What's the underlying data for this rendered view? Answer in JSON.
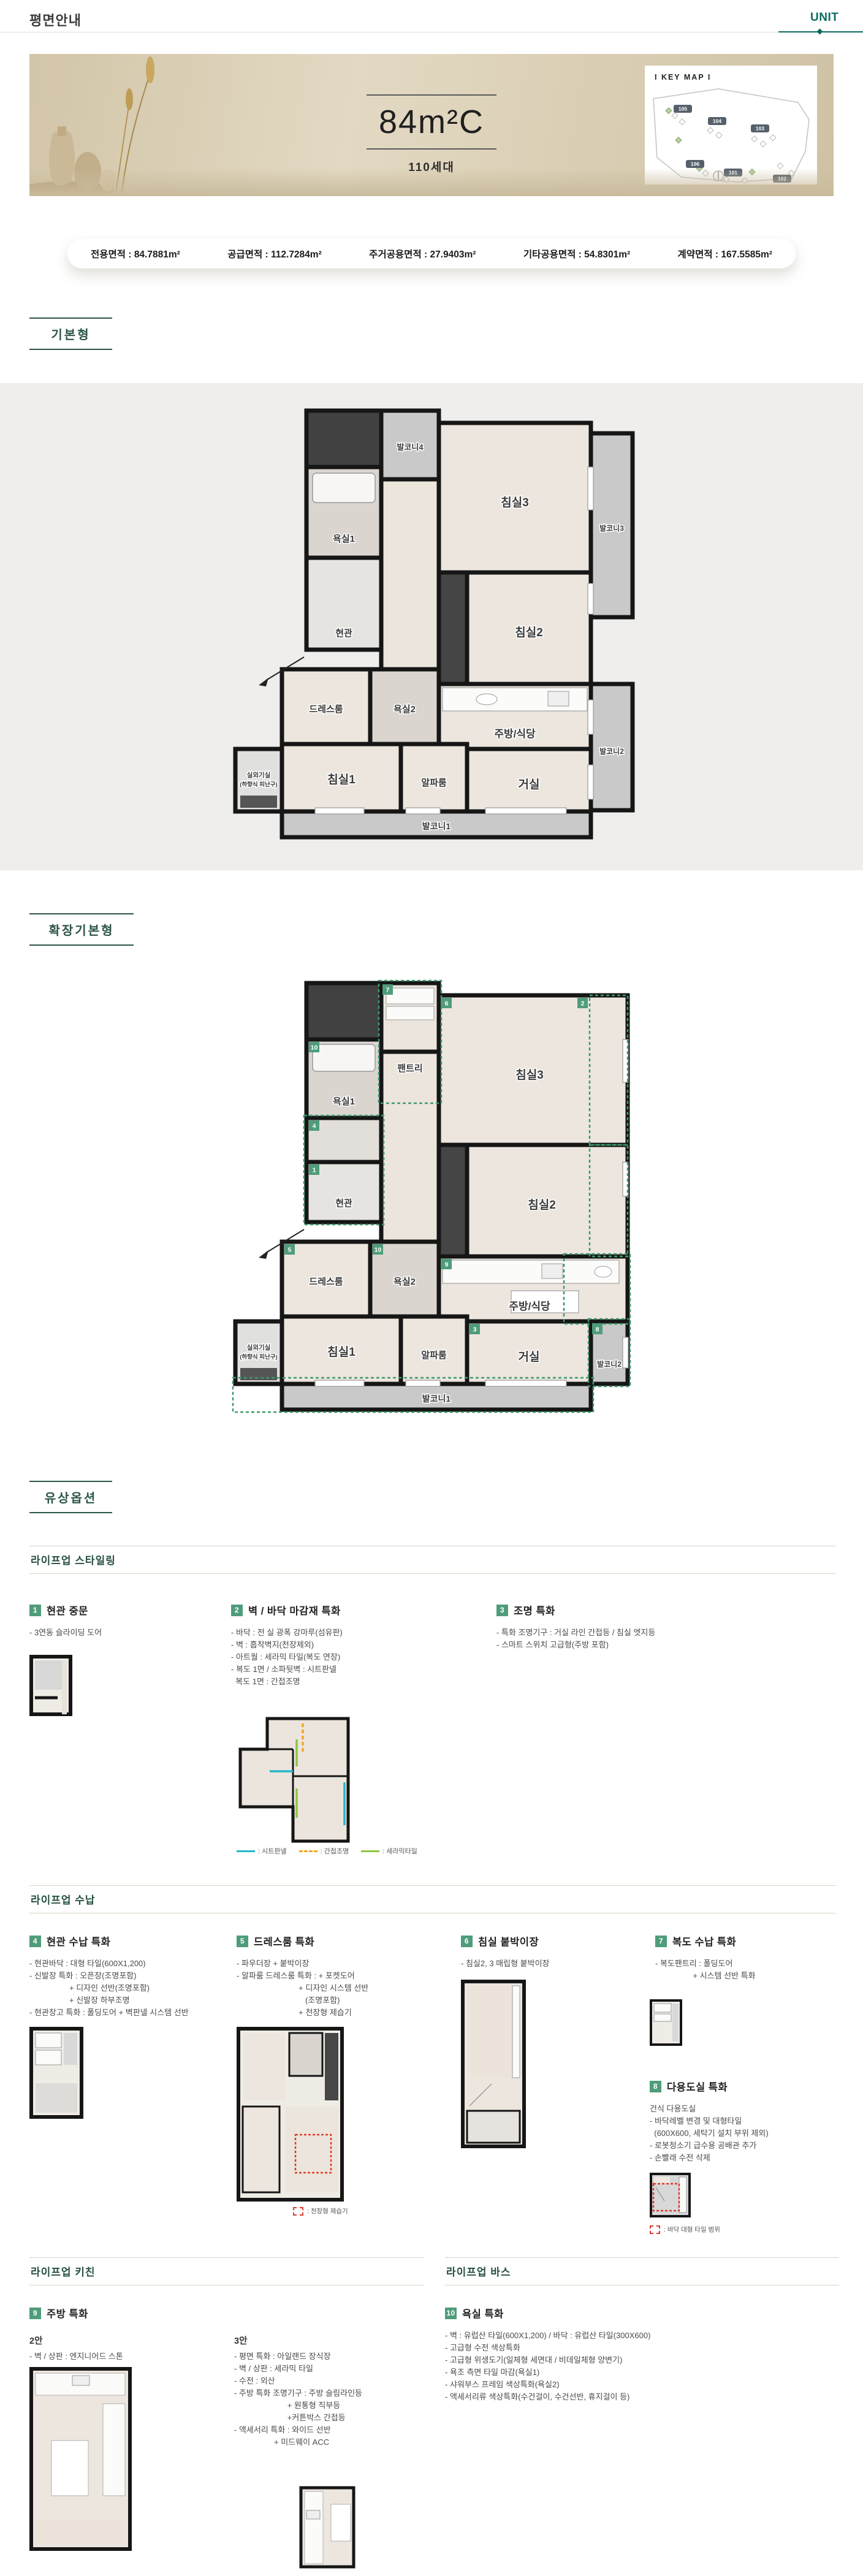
{
  "header": {
    "title": "평면안내",
    "tab": "UNIT"
  },
  "hero": {
    "unit_name": "84m²C",
    "households": "110세대",
    "keymap_title": "I KEY MAP I",
    "buildings": [
      "105",
      "104",
      "103",
      "106",
      "101",
      "102"
    ]
  },
  "area": {
    "items": [
      "전용면적 : 84.7881m²",
      "공급면적 : 112.7284m²",
      "주거공용면적 : 27.9403m²",
      "기타공용면적 : 54.8301m²",
      "계약면적 : 167.5585m²"
    ]
  },
  "section_labels": {
    "basic": "기본형",
    "extended": "확장기본형",
    "paid": "유상옵션"
  },
  "group_titles": {
    "styling": "라이프업 스타일링",
    "storage": "라이프업 수납",
    "kitchen": "라이프업 키친",
    "bath": "라이프업 바스"
  },
  "rooms": {
    "balcony1": "발코니1",
    "balcony2": "발코니2",
    "balcony3": "발코니3",
    "balcony4": "발코니4",
    "bath1": "욕실1",
    "bath2": "욕실2",
    "entrance": "현관",
    "bed1": "침실1",
    "bed2": "침실2",
    "bed3": "침실3",
    "dress": "드레스룸",
    "kitchen": "주방/식당",
    "living": "거실",
    "alpha": "알파룸",
    "outdoor": "실외기실",
    "outdoor_sub": "(하향식 피난구)",
    "pantry": "팬트리"
  },
  "plan_badges": [
    "1",
    "2",
    "3",
    "4",
    "5",
    "6",
    "7",
    "8",
    "9",
    "10"
  ],
  "options": [
    {
      "num": "1",
      "title": "현관 중문",
      "lines": [
        "- 3연동 슬라이딩 도어"
      ]
    },
    {
      "num": "2",
      "title": "벽 / 바닥 마감재 특화",
      "lines": [
        "- 바닥 : 전 실 광폭 강마루(섬유판)",
        "- 벽 : 흡착벽지(천장제외)",
        "- 아트월 : 세라믹 타일(복도 연장)",
        "- 복도 1면 / 소파뒷벽 : 시트판넬",
        "  복도 1면 : 간접조명"
      ]
    },
    {
      "num": "3",
      "title": "조명 특화",
      "lines": [
        "- 특화 조명기구 : 거실 라인 간접등 / 침실 엣지등",
        "- 스마트 스위치 고급형(주방 포함)"
      ]
    },
    {
      "num": "4",
      "title": "현관 수납 특화",
      "lines": [
        "- 현관바닥 : 대형 타일(600X1,200)",
        "- 신발장 특화 : 오픈장(조명포함)",
        "                  + 디자인 선반(조명포함)",
        "                  + 신발장 하부조명",
        "- 현관창고 특화 : 폴딩도어 + 벽판넬 시스템 선반"
      ]
    },
    {
      "num": "5",
      "title": "드레스룸 특화",
      "lines": [
        "- 파우더장 + 붙박이장",
        "- 알파룸 드레스룸 특화 : + 포켓도어",
        "                            + 디자인 시스템 선반",
        "                               (조명포함)",
        "                            + 천장형 제습기"
      ]
    },
    {
      "num": "6",
      "title": "침실 붙박이장",
      "lines": [
        "- 침실2, 3 매립형 붙박이장"
      ]
    },
    {
      "num": "7",
      "title": "복도 수납 특화",
      "lines": [
        "- 복도팬트리 : 폴딩도어",
        "                 + 시스템 선반 특화"
      ]
    },
    {
      "num": "8",
      "title": "다용도실 특화",
      "lines": [
        "건식 다용도실",
        "- 바닥레벨 변경 및 대형타일",
        "  (600X600, 세탁기 설치 부위 제외)",
        "- 로봇청소기 급수용 공배관 추가",
        "- 손빨래 수전 삭제"
      ]
    },
    {
      "num": "9",
      "title": "주방 특화",
      "variants": [
        {
          "label": "2안",
          "lines": [
            "- 벽 / 상판 : 엔지니어드 스톤"
          ]
        },
        {
          "label": "3안",
          "lines": [
            "- 평면 특화 : 아일랜드 장식장",
            "- 벽 / 상판 : 세라믹 타일",
            "- 수전 : 외산",
            "- 주방 특화 조명기구 : 주방 슬림라인등",
            "                        + 원통형 직부등",
            "                        +커튼박스 간접등",
            "- 액세서리 특화 : 와이드 선반",
            "                  + 미드웨이 ACC"
          ]
        }
      ]
    },
    {
      "num": "10",
      "title": "욕실 특화",
      "lines": [
        "- 벽 : 유럽산 타일(600X1,200) / 바닥 : 유럽산 타일(300X600)",
        "- 고급형 수전 색상특화",
        "- 고급형 위생도기(일체형 세면대 / 비데일체형 양변기)",
        "- 욕조 측면 타일 마감(욕실1)",
        "- 샤워부스 프레임 색상특화(욕실2)",
        "- 액세서리류 색상특화(수건걸이, 수건선반, 휴지걸이 등)"
      ]
    }
  ],
  "legends": {
    "finish": [
      {
        "label": ": 시트판넬",
        "color": "#29b6c8",
        "style": "solid"
      },
      {
        "label": ": 간접조명",
        "color": "#f5a623",
        "style": "dashed"
      },
      {
        "label": ": 세라믹타일",
        "color": "#8dc63f",
        "style": "solid"
      }
    ],
    "dehumidifier": ": 천장형 제습기",
    "tile_range": ": 바닥 대형 타일 범위",
    "highlight_red": "#e23a2e"
  },
  "colors": {
    "accent_green": "#2c5547",
    "badge_green": "#4f9c7b",
    "tab_teal": "#0b6b60"
  }
}
